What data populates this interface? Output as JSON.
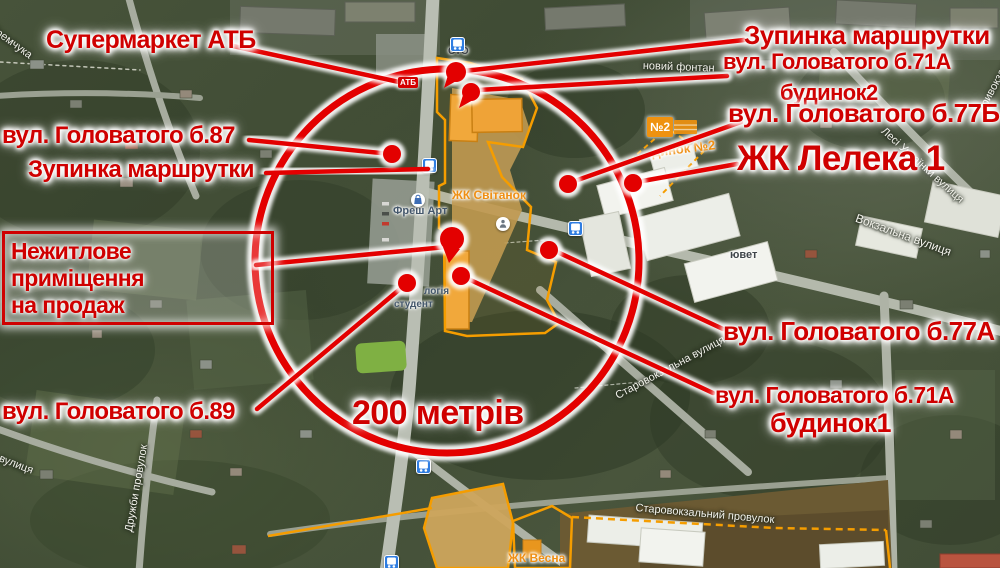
{
  "meta": {
    "description": "Satellite map annotated for a commercial property listing, 200 m radius highlight"
  },
  "colors": {
    "red_text": "#cf0000",
    "red_line": "#e30000",
    "orange_boundary": "#f59d00",
    "orange_poi_text": "#ef8f13",
    "map_green": "#47533a",
    "road_gray": "#b9beb3",
    "sand": "#c9a254",
    "white_building": "#eceee8",
    "bus_icon_blue": "#2f7de1"
  },
  "annotations": {
    "circle": {
      "cx": 447,
      "cy": 261,
      "r": 192,
      "label": "200 метрів"
    },
    "radius_label": {
      "id": "radius-200m",
      "text": "200 метрів",
      "x": 352,
      "y": 396,
      "size": 34
    },
    "box": {
      "id": "for-sale-box",
      "line1": "Нежитлове приміщення",
      "line2": "на продаж",
      "x": 2,
      "y": 231,
      "w": 254
    },
    "atb_sign": {
      "text": "АТБ",
      "x": 398,
      "y": 77
    },
    "labels": [
      {
        "id": "supermarket-atb",
        "text": "Супермаркет АТБ",
        "x": 46,
        "y": 28,
        "size": 25
      },
      {
        "id": "golovatogo-87",
        "text": "вул. Головатого  б.87",
        "x": 2,
        "y": 124,
        "size": 24
      },
      {
        "id": "stop-left",
        "text": "Зупинка маршрутки",
        "x": 28,
        "y": 158,
        "size": 24
      },
      {
        "id": "stop-right",
        "text": "Зупинка маршрутки",
        "x": 744,
        "y": 22,
        "size": 26
      },
      {
        "id": "g71a-b2-street",
        "text": "вул. Головатого  б.71А",
        "x": 723,
        "y": 51,
        "size": 22
      },
      {
        "id": "g71a-b2-house",
        "text": "будинок2",
        "x": 780,
        "y": 82,
        "size": 22
      },
      {
        "id": "golovatogo-77b",
        "text": "вул. Головатого  б.77Б",
        "x": 728,
        "y": 100,
        "size": 26
      },
      {
        "id": "zhk-leleka-1",
        "text": "ЖК Лелека 1",
        "x": 737,
        "y": 141,
        "size": 35
      },
      {
        "id": "golovatogo-77a",
        "text": "вул. Головатого  б.77А",
        "x": 723,
        "y": 318,
        "size": 26
      },
      {
        "id": "g71a-b1-street",
        "text": "вул. Головатого  б.71А",
        "x": 715,
        "y": 384,
        "size": 23
      },
      {
        "id": "g71a-b1-house",
        "text": "будинок1",
        "x": 770,
        "y": 410,
        "size": 27
      },
      {
        "id": "golovatogo-89",
        "text": "вул. Головатого  б.89",
        "x": 2,
        "y": 400,
        "size": 24
      }
    ],
    "lines": [
      {
        "id": "line-supermarket-atb",
        "x1": 233,
        "y1": 46,
        "x2": 399,
        "y2": 82
      },
      {
        "id": "line-stop-right",
        "x1": 744,
        "y1": 40,
        "x2": 464,
        "y2": 71
      },
      {
        "id": "line-g71a-b2",
        "x1": 727,
        "y1": 76,
        "x2": 478,
        "y2": 90
      },
      {
        "id": "line-golovatogo-77b",
        "x1": 741,
        "y1": 122,
        "x2": 572,
        "y2": 182
      },
      {
        "id": "line-zhk-leleka-1",
        "x1": 737,
        "y1": 164,
        "x2": 637,
        "y2": 182
      },
      {
        "id": "line-golovatogo-77a",
        "x1": 723,
        "y1": 329,
        "x2": 553,
        "y2": 250
      },
      {
        "id": "line-g71a-b1",
        "x1": 713,
        "y1": 393,
        "x2": 464,
        "y2": 277
      },
      {
        "id": "line-golovatogo-89",
        "x1": 257,
        "y1": 409,
        "x2": 406,
        "y2": 284
      },
      {
        "id": "line-golovatogo-87",
        "x1": 249,
        "y1": 140,
        "x2": 391,
        "y2": 154
      },
      {
        "id": "line-stop-left",
        "x1": 266,
        "y1": 173,
        "x2": 428,
        "y2": 169
      },
      {
        "id": "line-for-sale-box",
        "x1": 256,
        "y1": 265,
        "x2": 446,
        "y2": 247
      }
    ],
    "dots": [
      {
        "id": "dot-golovatogo-87",
        "x": 392,
        "y": 154,
        "r": 9
      },
      {
        "id": "dot-golovatogo-77b",
        "x": 568,
        "y": 184,
        "r": 9
      },
      {
        "id": "dot-zhk-leleka-1",
        "x": 633,
        "y": 183,
        "r": 9
      },
      {
        "id": "dot-golovatogo-77a",
        "x": 549,
        "y": 250,
        "r": 9
      },
      {
        "id": "dot-g71a-b1",
        "x": 461,
        "y": 276,
        "r": 9
      },
      {
        "id": "dot-golovatogo-89",
        "x": 407,
        "y": 283,
        "r": 9
      }
    ],
    "balloons": [
      {
        "id": "balloon-stop-right",
        "x": 456,
        "y": 72,
        "r": 10
      },
      {
        "id": "balloon-g71a-b2",
        "x": 471,
        "y": 92,
        "r": 9
      }
    ],
    "pin": {
      "id": "pin-for-sale",
      "x": 452,
      "y": 239,
      "r": 12,
      "tail_y": 263
    }
  },
  "map": {
    "n2_sign": {
      "text": "№2",
      "x": 647,
      "y": 117
    },
    "street_labels": [
      {
        "id": "street-yaremchuka",
        "text": "Юрія Яремчука",
        "x": -30,
        "y": 6,
        "size": 11,
        "rot": 36,
        "cls": "st"
      },
      {
        "id": "poi-novyi-fontan",
        "text": "новий фонтан",
        "x": 643,
        "y": 61,
        "size": 11,
        "rot": 2,
        "cls": "st"
      },
      {
        "id": "poi-sto",
        "text": "СТО",
        "x": 448,
        "y": 47,
        "size": 10,
        "rot": 0,
        "cls": "poi-dark"
      },
      {
        "id": "street-pryvokzalna",
        "text": "Привокзальна",
        "x": 976,
        "y": 110,
        "size": 11,
        "rot": -62,
        "cls": "st"
      },
      {
        "id": "street-lesi-ukrainky",
        "text": "Лесі Українки вулиця",
        "x": 886,
        "y": 126,
        "size": 11,
        "rot": 42,
        "cls": "st"
      },
      {
        "id": "street-vokzalna",
        "text": "Вокзальна вулиця",
        "x": 858,
        "y": 212,
        "size": 12,
        "rot": 20,
        "cls": "st"
      },
      {
        "id": "street-starovokzalna",
        "text": "Старовокзальна вулиця",
        "x": 614,
        "y": 392,
        "size": 11,
        "rot": -28,
        "cls": "st"
      },
      {
        "id": "street-starovokz-prov",
        "text": "Старовокзальний провулок",
        "x": 636,
        "y": 503,
        "size": 11,
        "rot": 5,
        "cls": "st"
      },
      {
        "id": "street-druzhby",
        "text": "Дружби провулок",
        "x": 124,
        "y": 531,
        "size": 11,
        "rot": -80,
        "cls": "st"
      },
      {
        "id": "street-yosyfska",
        "text": "Йосифська вулиця",
        "x": -55,
        "y": 432,
        "size": 11,
        "rot": 21,
        "cls": "st"
      },
      {
        "id": "poi-yuvet",
        "text": "ювет",
        "x": 730,
        "y": 250,
        "size": 11,
        "rot": 0,
        "cls": "poi-dark"
      },
      {
        "id": "poi-fresh-art",
        "text": "Фреш Арт",
        "x": 393,
        "y": 206,
        "size": 11,
        "rot": 0,
        "cls": "poi-blue"
      },
      {
        "id": "poi-logiia",
        "text": "логія",
        "x": 424,
        "y": 287,
        "size": 10,
        "rot": 0,
        "cls": "poi-blue"
      },
      {
        "id": "poi-studenty",
        "text": "студент",
        "x": 394,
        "y": 300,
        "size": 10,
        "rot": 0,
        "cls": "poi-blue"
      },
      {
        "id": "poi-zhk-svitanok",
        "text": "ЖК Світанок",
        "x": 452,
        "y": 189,
        "size": 12,
        "rot": 0,
        "cls": "zhk"
      },
      {
        "id": "poi-zhk-vesna",
        "text": "ЖК Весна",
        "x": 508,
        "y": 552,
        "size": 12,
        "rot": 0,
        "cls": "zhk"
      },
      {
        "id": "poi-budynok-2",
        "text": "динок №2",
        "x": 651,
        "y": 146,
        "size": 13,
        "rot": -7,
        "cls": "zhk"
      }
    ],
    "bus_stops": [
      {
        "x": 450,
        "y": 37
      },
      {
        "x": 422,
        "y": 158
      },
      {
        "x": 568,
        "y": 221
      },
      {
        "x": 416,
        "y": 459
      },
      {
        "x": 384,
        "y": 555
      }
    ],
    "poi_icons": [
      {
        "id": "shopping-bag-icon",
        "x": 411,
        "y": 193
      },
      {
        "id": "info-circle-icon",
        "x": 496,
        "y": 217
      }
    ]
  }
}
